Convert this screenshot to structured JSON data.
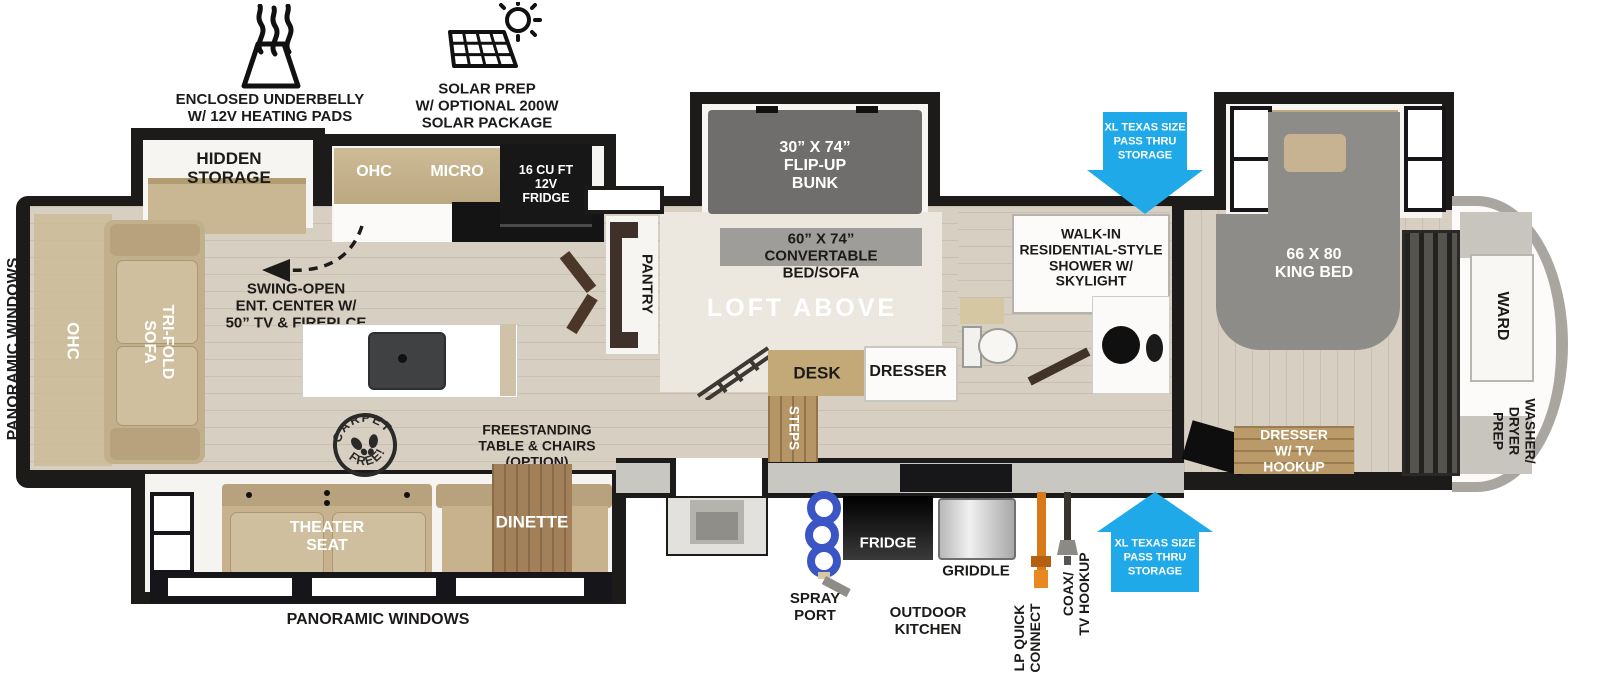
{
  "features": {
    "underbelly": "ENCLOSED UNDERBELLY\nW/ 12V HEATING PADS",
    "solar": "SOLAR PREP\nW/ OPTIONAL 200W\nSOLAR PACKAGE"
  },
  "exterior": {
    "panoramic_left": "PANORAMIC WINDOWS",
    "panoramic_bottom": "PANORAMIC WINDOWS",
    "pass_thru_top": "XL TEXAS SIZE\nPASS THRU\nSTORAGE",
    "pass_thru_bottom": "XL TEXAS SIZE\nPASS THRU\nSTORAGE",
    "spray_port": "SPRAY\nPORT",
    "fridge": "FRIDGE",
    "griddle": "GRIDDLE",
    "outdoor_kitchen": "OUTDOOR\nKITCHEN",
    "lp_quick_connect": "LP QUICK\nCONNECT",
    "coax_tv": "COAX/\nTV HOOKUP"
  },
  "living": {
    "hidden_storage": "HIDDEN\nSTORAGE",
    "ohc_rear": "OHC",
    "tri_fold_sofa": "TRI-FOLD\nSOFA",
    "ent_center": "SWING-OPEN\nENT. CENTER W/\n50” TV & FIREPLCE",
    "carpet_top": "CARPET",
    "carpet_bottom": "FREE!",
    "freestanding_table": "FREESTANDING\nTABLE & CHAIRS\n(OPTION)",
    "theater_seat": "THEATER\nSEAT",
    "dinette": "DINETTE"
  },
  "kitchen": {
    "ohc": "OHC",
    "micro": "MICRO",
    "fridge": "16 CU FT\n12V\nFRIDGE",
    "pantry": "PANTRY",
    "steps": "STEPS"
  },
  "bunk_room": {
    "flip_up_bunk": "30” X 74”\nFLIP-UP\nBUNK",
    "convertible_bed": "60” X 74”\nCONVERTABLE\nBED/SOFA",
    "loft": "LOFT ABOVE",
    "desk": "DESK",
    "dresser": "DRESSER"
  },
  "bathroom": {
    "shower": "WALK-IN\nRESIDENTIAL-STYLE\nSHOWER W/\nSKYLIGHT"
  },
  "bedroom": {
    "king_bed": "66 X 80\nKING BED",
    "dresser_tv": "DRESSER\nW/ TV\nHOOKUP",
    "ward": "WARD",
    "washer_dryer": "WASHER/\nDRYER\nPREP"
  },
  "colors": {
    "accent_blue": "#1fa9e8",
    "wall_black": "#1d1b19",
    "floor_wood": "#d7cfc1",
    "cabinet_tan": "#c7b28d",
    "bed_gray": "#8e8c88"
  }
}
